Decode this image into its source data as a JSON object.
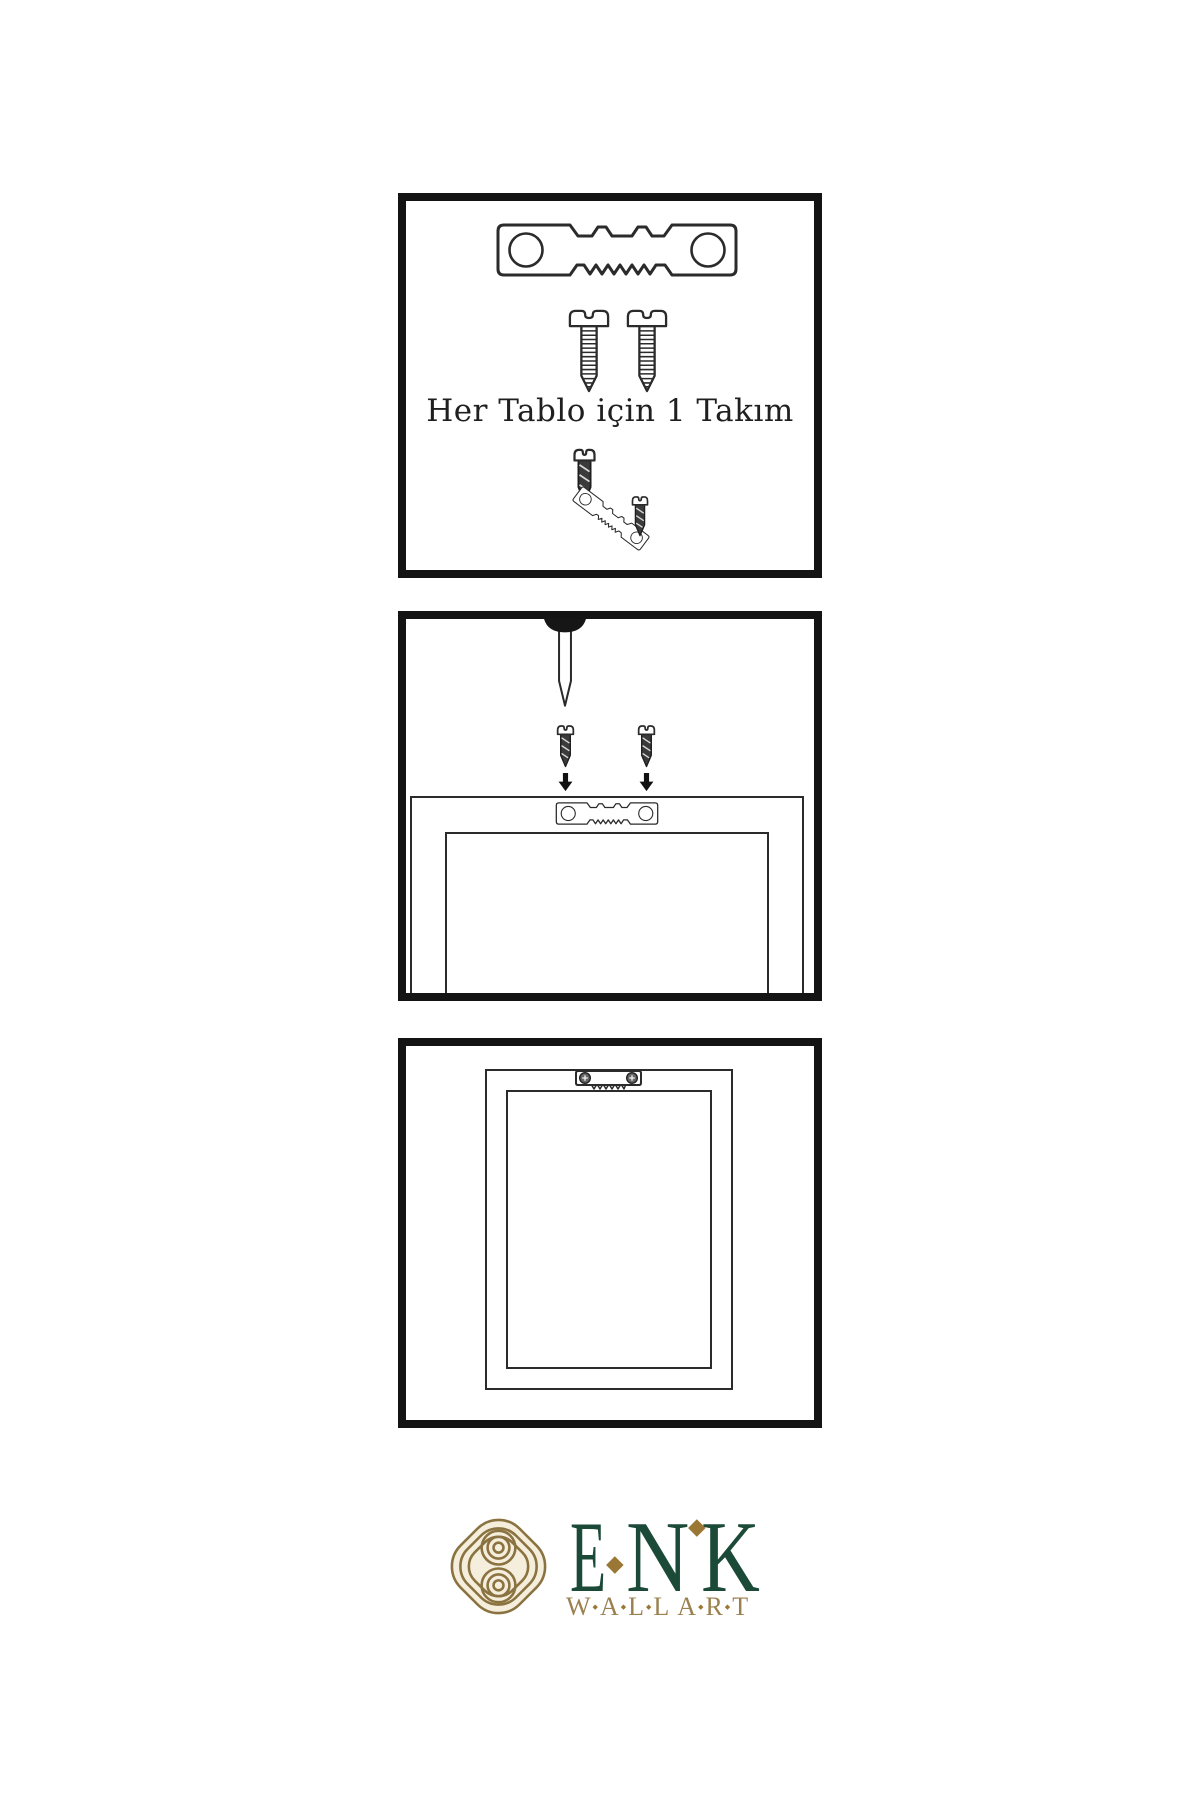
{
  "page": {
    "background": "#ffffff"
  },
  "colors": {
    "line": "#2b2b2b",
    "panel_border": "#141414",
    "screw_dark": "#3b3b3b",
    "arrow": "#111111"
  },
  "instructions": {
    "step1": {
      "caption": "Her Tablo için 1 Takım",
      "items": [
        "sawtooth-hanger-plate",
        "mounting-screw",
        "mounting-screw",
        "screw-with-tilted-hanger"
      ]
    },
    "step2": {
      "items": [
        "wall-nail",
        "mounting-screw-with-down-arrow",
        "mounting-screw-with-down-arrow",
        "frame-back-with-sawtooth-hanger"
      ]
    },
    "step3": {
      "items": [
        "hung-frame-with-sawtooth-hanger"
      ]
    }
  },
  "logo": {
    "name_letters": [
      "E",
      "N",
      "K"
    ],
    "subtitle_words": [
      "WALL",
      "ART"
    ],
    "colors": {
      "green": "#1c4a38",
      "gold": "#9c8150",
      "diamond": "#9a7734",
      "knot": "#8a7340",
      "knot_bg": "#f6eedd"
    }
  }
}
